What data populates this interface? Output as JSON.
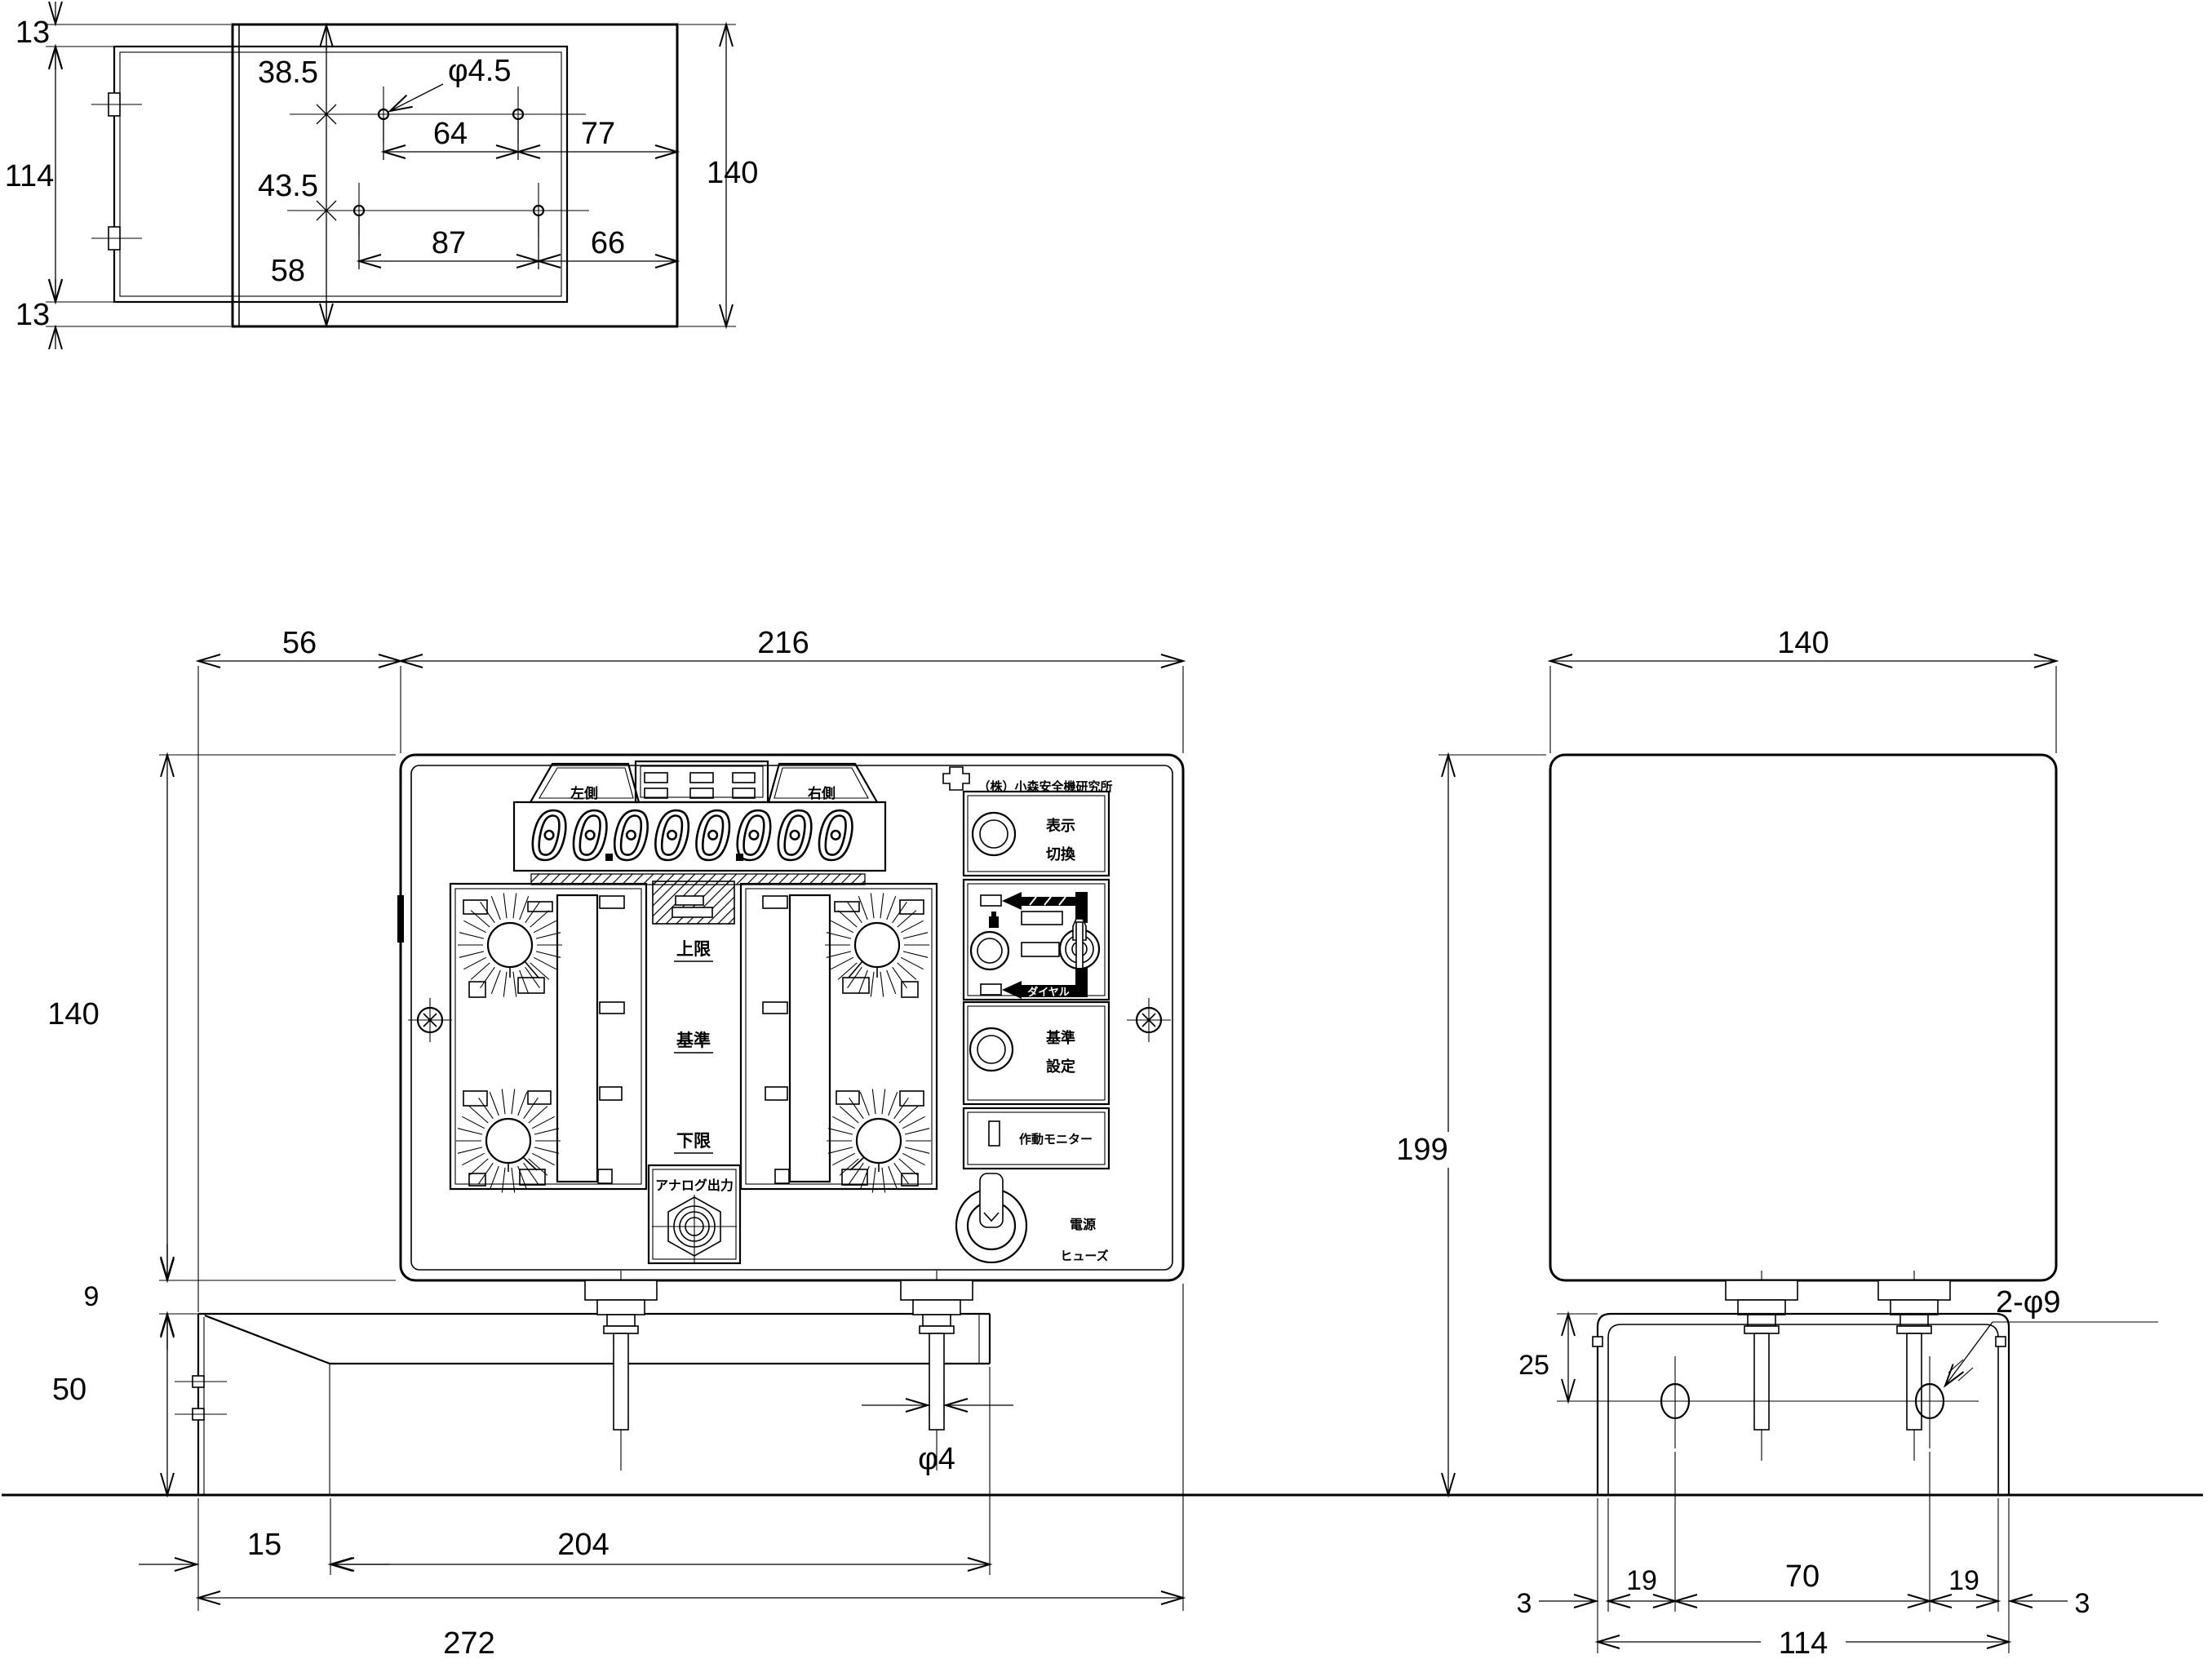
{
  "top_view": {
    "dim_13_top": "13",
    "dim_114": "114",
    "dim_13_bottom": "13",
    "dim_38_5": "38.5",
    "dim_43_5": "43.5",
    "dim_58": "58",
    "dim_64": "64",
    "dim_77": "77",
    "dim_87": "87",
    "dim_66": "66",
    "dim_140": "140",
    "hole_callout": "φ4.5"
  },
  "front_view": {
    "dim_56": "56",
    "dim_216": "216",
    "dim_140": "140",
    "dim_9": "9",
    "dim_50": "50",
    "dim_15": "15",
    "dim_204": "204",
    "dim_272": "272",
    "stud_callout": "φ4"
  },
  "panel": {
    "display_left_label": "左側",
    "display_right_label": "右側",
    "display_value": "00000000",
    "label_upper_limit": "上限",
    "label_reference": "基準",
    "label_lower_limit": "下限",
    "analog_output_label": "アナログ出力",
    "maker_name": "（株）小森安全機研究所",
    "display_switch_line1": "表示",
    "display_switch_line2": "切換",
    "dial_arrow_label": "ダイヤル",
    "ref_set_line1": "基準",
    "ref_set_line2": "設定",
    "monitor_label": "作動モニター",
    "power_label": "電源",
    "fuse_label": "ヒューズ"
  },
  "side_view": {
    "dim_140": "140",
    "dim_199": "199",
    "dim_25": "25",
    "hole_callout": "2-φ9",
    "dim_3_left": "3",
    "dim_19_left": "19",
    "dim_70": "70",
    "dim_19_right": "19",
    "dim_3_right": "3",
    "dim_114": "114"
  }
}
